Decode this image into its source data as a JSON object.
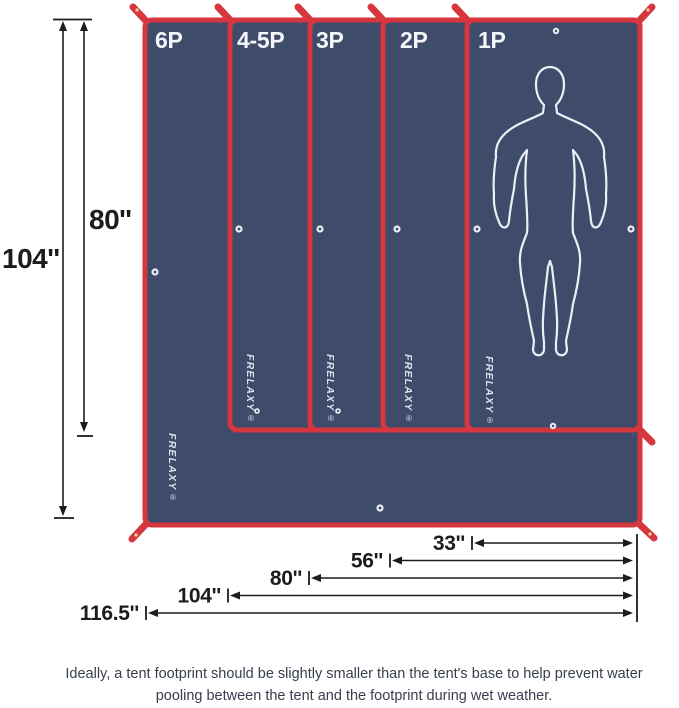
{
  "colors": {
    "background": "#ffffff",
    "tarp-navy": "#3e4b6b",
    "edge-red": "#d6363d",
    "strap-buckle": "#ecd9a4",
    "grommet-ring": "#e9ecf1",
    "silhouette-white": "#eaeef5",
    "label-white": "#f4f6f9",
    "dim-black": "#1c1c1c",
    "caption-dark": "#373f4d"
  },
  "diagram": {
    "panels": [
      {
        "label": "6P"
      },
      {
        "label": "4-5P"
      },
      {
        "label": "3P"
      },
      {
        "label": "2P"
      },
      {
        "label": "1P"
      }
    ],
    "brand": "FRELAXY",
    "registered_mark": "®",
    "vertical_dimensions": [
      {
        "label": "104''"
      },
      {
        "label": "80''"
      }
    ],
    "horizontal_dimensions": [
      {
        "label": "33''"
      },
      {
        "label": "56''"
      },
      {
        "label": "80''"
      },
      {
        "label": "104''"
      },
      {
        "label": "116.5''"
      }
    ]
  },
  "caption": {
    "line1": "Ideally, a tent footprint should be slightly smaller than the tent's base to help prevent water",
    "line2": "pooling between the tent and the footprint during wet weather."
  }
}
